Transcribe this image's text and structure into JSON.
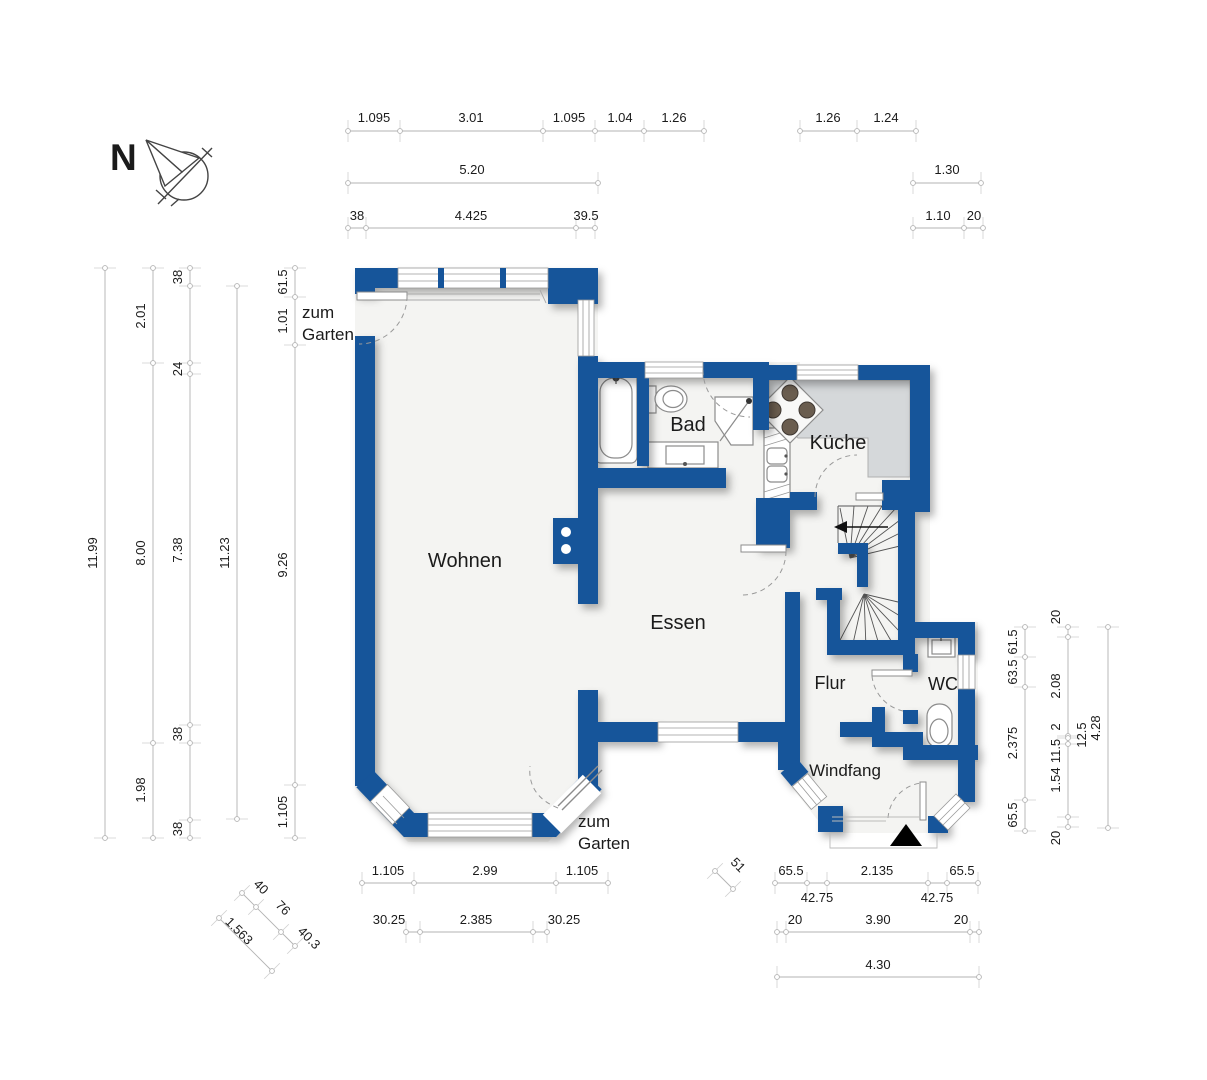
{
  "colors": {
    "wall_blue": "#15549a",
    "floor": "#f4f4f2",
    "counter_gray": "#d5d8da",
    "dim_line": "#b3b3b3",
    "fixture_stroke": "#8c8c8c",
    "text": "#1b1b1b"
  },
  "compass": {
    "label": "N"
  },
  "texts": [
    {
      "name": "room-label-wohnen",
      "text": "Wohnen",
      "x": 465,
      "y": 567,
      "size": 20
    },
    {
      "name": "room-label-essen",
      "text": "Essen",
      "x": 678,
      "y": 629,
      "size": 20
    },
    {
      "name": "room-label-kueche",
      "text": "Küche",
      "x": 838,
      "y": 449,
      "size": 20
    },
    {
      "name": "room-label-bad",
      "text": "Bad",
      "x": 688,
      "y": 431,
      "size": 20
    },
    {
      "name": "room-label-flur",
      "text": "Flur",
      "x": 830,
      "y": 689,
      "size": 18
    },
    {
      "name": "room-label-wc",
      "text": "WC",
      "x": 943,
      "y": 690,
      "size": 18
    },
    {
      "name": "room-label-windfang",
      "text": "Windfang",
      "x": 845,
      "y": 776,
      "size": 17
    },
    {
      "name": "garden-door-label",
      "text": "zum",
      "x": 302,
      "y": 318,
      "size": 17,
      "anchor": "start"
    },
    {
      "name": "garden-door-label",
      "text": "Garten",
      "x": 302,
      "y": 340,
      "size": 17,
      "anchor": "start"
    },
    {
      "name": "garden-door-label",
      "text": "zum",
      "x": 578,
      "y": 827,
      "size": 17,
      "anchor": "start"
    },
    {
      "name": "garden-door-label",
      "text": "Garten",
      "x": 578,
      "y": 849,
      "size": 17,
      "anchor": "start"
    },
    {
      "name": "dimension-label",
      "text": "1.095",
      "x": 374,
      "y": 122
    },
    {
      "name": "dimension-label",
      "text": "3.01",
      "x": 471,
      "y": 122
    },
    {
      "name": "dimension-label",
      "text": "1.095",
      "x": 569,
      "y": 122
    },
    {
      "name": "dimension-label",
      "text": "1.04",
      "x": 620,
      "y": 122
    },
    {
      "name": "dimension-label",
      "text": "1.26",
      "x": 674,
      "y": 122
    },
    {
      "name": "dimension-label",
      "text": "1.26",
      "x": 828,
      "y": 122
    },
    {
      "name": "dimension-label",
      "text": "1.24",
      "x": 886,
      "y": 122
    },
    {
      "name": "dimension-label",
      "text": "5.20",
      "x": 472,
      "y": 174
    },
    {
      "name": "dimension-label",
      "text": "1.30",
      "x": 947,
      "y": 174
    },
    {
      "name": "dimension-label",
      "text": "38",
      "x": 357,
      "y": 220
    },
    {
      "name": "dimension-label",
      "text": "4.425",
      "x": 471,
      "y": 220
    },
    {
      "name": "dimension-label",
      "text": "39.5",
      "x": 586,
      "y": 220
    },
    {
      "name": "dimension-label",
      "text": "1.10",
      "x": 938,
      "y": 220
    },
    {
      "name": "dimension-label",
      "text": "20",
      "x": 974,
      "y": 220
    },
    {
      "name": "dimension-label",
      "text": "11.99",
      "x": 97,
      "y": 553,
      "rot": -90
    },
    {
      "name": "dimension-label",
      "text": "2.01",
      "x": 145,
      "y": 316,
      "rot": -90
    },
    {
      "name": "dimension-label",
      "text": "8.00",
      "x": 145,
      "y": 553,
      "rot": -90
    },
    {
      "name": "dimension-label",
      "text": "1.98",
      "x": 145,
      "y": 790,
      "rot": -90
    },
    {
      "name": "dimension-label",
      "text": "38",
      "x": 182,
      "y": 277,
      "rot": -90
    },
    {
      "name": "dimension-label",
      "text": "24",
      "x": 182,
      "y": 369,
      "rot": -90
    },
    {
      "name": "dimension-label",
      "text": "7.38",
      "x": 182,
      "y": 550,
      "rot": -90
    },
    {
      "name": "dimension-label",
      "text": "38",
      "x": 182,
      "y": 734,
      "rot": -90
    },
    {
      "name": "dimension-label",
      "text": "38",
      "x": 182,
      "y": 829,
      "rot": -90
    },
    {
      "name": "dimension-label",
      "text": "11.23",
      "x": 229,
      "y": 553,
      "rot": -90
    },
    {
      "name": "dimension-label",
      "text": "61.5",
      "x": 287,
      "y": 282,
      "rot": -90
    },
    {
      "name": "dimension-label",
      "text": "1.01",
      "x": 287,
      "y": 321,
      "rot": -90
    },
    {
      "name": "dimension-label",
      "text": "9.26",
      "x": 287,
      "y": 565,
      "rot": -90
    },
    {
      "name": "dimension-label",
      "text": "1.105",
      "x": 287,
      "y": 812,
      "rot": -90
    },
    {
      "name": "dimension-label",
      "text": "61.5",
      "x": 1017,
      "y": 642,
      "rot": -90
    },
    {
      "name": "dimension-label",
      "text": "63.5",
      "x": 1017,
      "y": 672,
      "rot": -90
    },
    {
      "name": "dimension-label",
      "text": "2.375",
      "x": 1017,
      "y": 743,
      "rot": -90
    },
    {
      "name": "dimension-label",
      "text": "65.5",
      "x": 1017,
      "y": 815,
      "rot": -90
    },
    {
      "name": "dimension-label",
      "text": "20",
      "x": 1060,
      "y": 617,
      "rot": -90
    },
    {
      "name": "dimension-label",
      "text": "2.08",
      "x": 1060,
      "y": 686,
      "rot": -90
    },
    {
      "name": "dimension-label",
      "text": "2",
      "x": 1060,
      "y": 727,
      "rot": -90
    },
    {
      "name": "dimension-label",
      "text": "11.5",
      "x": 1060,
      "y": 751,
      "rot": -90
    },
    {
      "name": "dimension-label",
      "text": "1.54",
      "x": 1060,
      "y": 780,
      "rot": -90
    },
    {
      "name": "dimension-label",
      "text": "20",
      "x": 1060,
      "y": 838,
      "rot": -90
    },
    {
      "name": "dimension-label",
      "text": "12.5",
      "x": 1086,
      "y": 735,
      "rot": -90
    },
    {
      "name": "dimension-label",
      "text": "4.28",
      "x": 1100,
      "y": 728,
      "rot": -90
    },
    {
      "name": "dimension-label",
      "text": "1.105",
      "x": 388,
      "y": 875
    },
    {
      "name": "dimension-label",
      "text": "2.99",
      "x": 485,
      "y": 875
    },
    {
      "name": "dimension-label",
      "text": "1.105",
      "x": 582,
      "y": 875
    },
    {
      "name": "dimension-label",
      "text": "30.25",
      "x": 389,
      "y": 924
    },
    {
      "name": "dimension-label",
      "text": "2.385",
      "x": 476,
      "y": 924
    },
    {
      "name": "dimension-label",
      "text": "30.25",
      "x": 564,
      "y": 924
    },
    {
      "name": "dimension-label",
      "text": "40",
      "x": 258,
      "y": 890,
      "rot": 45
    },
    {
      "name": "dimension-label",
      "text": "76",
      "x": 280,
      "y": 911,
      "rot": 45
    },
    {
      "name": "dimension-label",
      "text": "40.3",
      "x": 306,
      "y": 941,
      "rot": 45
    },
    {
      "name": "dimension-label",
      "text": "1.563",
      "x": 236,
      "y": 934,
      "rot": 45
    },
    {
      "name": "dimension-label",
      "text": "51",
      "x": 735,
      "y": 868,
      "rot": 45
    },
    {
      "name": "dimension-label",
      "text": "65.5",
      "x": 791,
      "y": 875
    },
    {
      "name": "dimension-label",
      "text": "2.135",
      "x": 877,
      "y": 875
    },
    {
      "name": "dimension-label",
      "text": "65.5",
      "x": 962,
      "y": 875
    },
    {
      "name": "dimension-label",
      "text": "42.75",
      "x": 817,
      "y": 902
    },
    {
      "name": "dimension-label",
      "text": "42.75",
      "x": 937,
      "y": 902
    },
    {
      "name": "dimension-label",
      "text": "20",
      "x": 795,
      "y": 924
    },
    {
      "name": "dimension-label",
      "text": "3.90",
      "x": 878,
      "y": 924
    },
    {
      "name": "dimension-label",
      "text": "20",
      "x": 961,
      "y": 924
    },
    {
      "name": "dimension-label",
      "text": "4.30",
      "x": 878,
      "y": 969
    }
  ],
  "dimension_chains": [
    {
      "x1": 348,
      "y1": 131,
      "x2": 704,
      "y2": 131,
      "ticks": [
        [
          348,
          131
        ],
        [
          400,
          131
        ],
        [
          543,
          131
        ],
        [
          595,
          131
        ],
        [
          644,
          131
        ],
        [
          704,
          131
        ]
      ]
    },
    {
      "x1": 800,
      "y1": 131,
      "x2": 916,
      "y2": 131,
      "ticks": [
        [
          800,
          131
        ],
        [
          857,
          131
        ],
        [
          916,
          131
        ]
      ]
    },
    {
      "x1": 348,
      "y1": 183,
      "x2": 598,
      "y2": 183,
      "ticks": [
        [
          348,
          183
        ],
        [
          598,
          183
        ]
      ]
    },
    {
      "x1": 913,
      "y1": 183,
      "x2": 981,
      "y2": 183,
      "ticks": [
        [
          913,
          183
        ],
        [
          981,
          183
        ]
      ]
    },
    {
      "x1": 348,
      "y1": 228,
      "x2": 595,
      "y2": 228,
      "ticks": [
        [
          348,
          228
        ],
        [
          366,
          228
        ],
        [
          576,
          228
        ],
        [
          595,
          228
        ]
      ]
    },
    {
      "x1": 913,
      "y1": 228,
      "x2": 983,
      "y2": 228,
      "ticks": [
        [
          913,
          228
        ],
        [
          964,
          228
        ],
        [
          983,
          228
        ]
      ]
    },
    {
      "x1": 362,
      "y1": 883,
      "x2": 608,
      "y2": 883,
      "ticks": [
        [
          362,
          883
        ],
        [
          414,
          883
        ],
        [
          556,
          883
        ],
        [
          608,
          883
        ]
      ]
    },
    {
      "x1": 406,
      "y1": 932,
      "x2": 547,
      "y2": 932,
      "ticks": [
        [
          406,
          932
        ],
        [
          420,
          932
        ],
        [
          533,
          932
        ],
        [
          547,
          932
        ]
      ]
    },
    {
      "x1": 775,
      "y1": 883,
      "x2": 978,
      "y2": 883,
      "ticks": [
        [
          775,
          883
        ],
        [
          807,
          883
        ],
        [
          827,
          883
        ],
        [
          928,
          883
        ],
        [
          947,
          883
        ],
        [
          978,
          883
        ]
      ]
    },
    {
      "x1": 777,
      "y1": 932,
      "x2": 979,
      "y2": 932,
      "ticks": [
        [
          777,
          932
        ],
        [
          786,
          932
        ],
        [
          970,
          932
        ],
        [
          979,
          932
        ]
      ]
    },
    {
      "x1": 777,
      "y1": 977,
      "x2": 979,
      "y2": 977,
      "ticks": [
        [
          777,
          977
        ],
        [
          979,
          977
        ]
      ]
    },
    {
      "x1": 105,
      "y1": 268,
      "x2": 105,
      "y2": 838,
      "ticks": [
        [
          105,
          268
        ],
        [
          105,
          838
        ]
      ]
    },
    {
      "x1": 153,
      "y1": 268,
      "x2": 153,
      "y2": 838,
      "ticks": [
        [
          153,
          268
        ],
        [
          153,
          363
        ],
        [
          153,
          743
        ],
        [
          153,
          838
        ]
      ]
    },
    {
      "x1": 190,
      "y1": 268,
      "x2": 190,
      "y2": 838,
      "ticks": [
        [
          190,
          268
        ],
        [
          190,
          286
        ],
        [
          190,
          363
        ],
        [
          190,
          374
        ],
        [
          190,
          725
        ],
        [
          190,
          743
        ],
        [
          190,
          820
        ],
        [
          190,
          838
        ]
      ]
    },
    {
      "x1": 237,
      "y1": 286,
      "x2": 237,
      "y2": 819,
      "ticks": [
        [
          237,
          286
        ],
        [
          237,
          819
        ]
      ]
    },
    {
      "x1": 295,
      "y1": 268,
      "x2": 295,
      "y2": 838,
      "ticks": [
        [
          295,
          268
        ],
        [
          295,
          297
        ],
        [
          295,
          345
        ],
        [
          295,
          785
        ],
        [
          295,
          838
        ]
      ]
    },
    {
      "x1": 1025,
      "y1": 627,
      "x2": 1025,
      "y2": 831,
      "ticks": [
        [
          1025,
          627
        ],
        [
          1025,
          657
        ],
        [
          1025,
          687
        ],
        [
          1025,
          800
        ],
        [
          1025,
          831
        ]
      ]
    },
    {
      "x1": 1068,
      "y1": 627,
      "x2": 1068,
      "y2": 827,
      "ticks": [
        [
          1068,
          627
        ],
        [
          1068,
          637
        ],
        [
          1068,
          736
        ],
        [
          1068,
          738
        ],
        [
          1068,
          744
        ],
        [
          1068,
          817
        ],
        [
          1068,
          827
        ]
      ]
    },
    {
      "x1": 1108,
      "y1": 627,
      "x2": 1108,
      "y2": 828,
      "ticks": [
        [
          1108,
          627
        ],
        [
          1108,
          828
        ]
      ]
    },
    {
      "x1": 242,
      "y1": 893,
      "x2": 295,
      "y2": 946,
      "ticks": [
        [
          242,
          893
        ],
        [
          256,
          907
        ],
        [
          281,
          932
        ],
        [
          295,
          946
        ]
      ]
    },
    {
      "x1": 219,
      "y1": 918,
      "x2": 272,
      "y2": 971,
      "ticks": [
        [
          219,
          918
        ],
        [
          272,
          971
        ]
      ]
    },
    {
      "x1": 715,
      "y1": 871,
      "x2": 733,
      "y2": 889,
      "ticks": [
        [
          715,
          871
        ],
        [
          733,
          889
        ]
      ]
    }
  ]
}
